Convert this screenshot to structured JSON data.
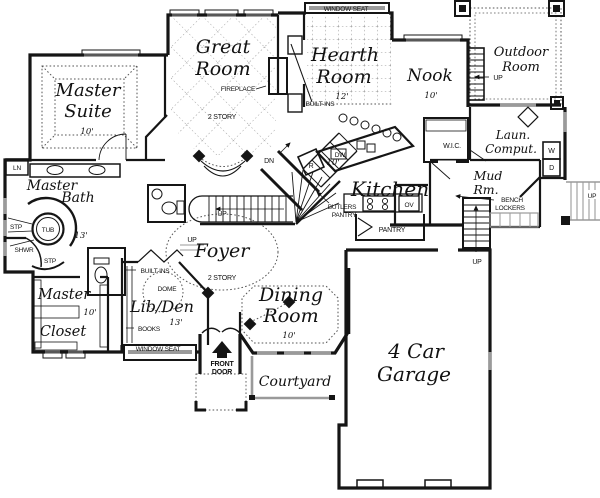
{
  "canvas": {
    "width": 600,
    "height": 498,
    "background": "#ffffff"
  },
  "colors": {
    "wall": "#151515",
    "window_gray": "#9a9a9a",
    "dotted": "#555555",
    "stair_gray": "#8a8a8a"
  },
  "rooms": {
    "master_suite": {
      "line1": "Master",
      "line2": "Suite",
      "dim": "10'"
    },
    "great_room": {
      "line1": "Great",
      "line2": "Room",
      "fireplace": "FIREPLACE",
      "story": "2 STORY"
    },
    "hearth_room": {
      "line1": "Hearth",
      "line2": "Room",
      "dim": "12'",
      "window_seat": "WINDOW SEAT",
      "builtins": "BUILT-INS"
    },
    "nook": {
      "name": "Nook",
      "dim": "10'"
    },
    "outdoor_room": {
      "line1": "Outdoor",
      "line2": "Room"
    },
    "laundry": {
      "line1": "Laun.",
      "line2": "Comput.",
      "washer": "W",
      "dryer": "D"
    },
    "wic": {
      "name": "W.I.C."
    },
    "mud_room": {
      "line1": "Mud",
      "line2": "Rm.",
      "bench1": "BENCH",
      "bench2": "LOCKERS"
    },
    "kitchen": {
      "name": "Kitchen",
      "dim": "10'",
      "dishwasher": "DW",
      "range": "R",
      "oven": "OV",
      "butlers1": "BUTLERS",
      "butlers2": "PANTRY",
      "pantry": "PANTRY"
    },
    "master_bath": {
      "line1": "Master",
      "line2": "Bath",
      "dim": "13'",
      "linen": "LN",
      "tub": "TUB",
      "step": "STP",
      "shower": "SHWR",
      "step2": "STP"
    },
    "master_closet": {
      "line1": "Master",
      "line2": "Closet",
      "dim": "10'"
    },
    "lib_den": {
      "name": "Lib/Den",
      "dim": "13'",
      "builtins": "BUILT-INS",
      "dome": "DOME",
      "books": "BOOKS",
      "window_seat": "WINDOW SEAT"
    },
    "foyer": {
      "name": "Foyer",
      "story": "2 STORY"
    },
    "dining_room": {
      "line1": "Dining",
      "line2": "Room",
      "dim": "10'"
    },
    "courtyard": {
      "name": "Courtyard"
    },
    "front_door": {
      "line1": "FRONT",
      "line2": "DOOR"
    },
    "garage": {
      "line1": "4 Car",
      "line2": "Garage"
    }
  },
  "stairs": {
    "up": "UP",
    "dn": "DN"
  }
}
